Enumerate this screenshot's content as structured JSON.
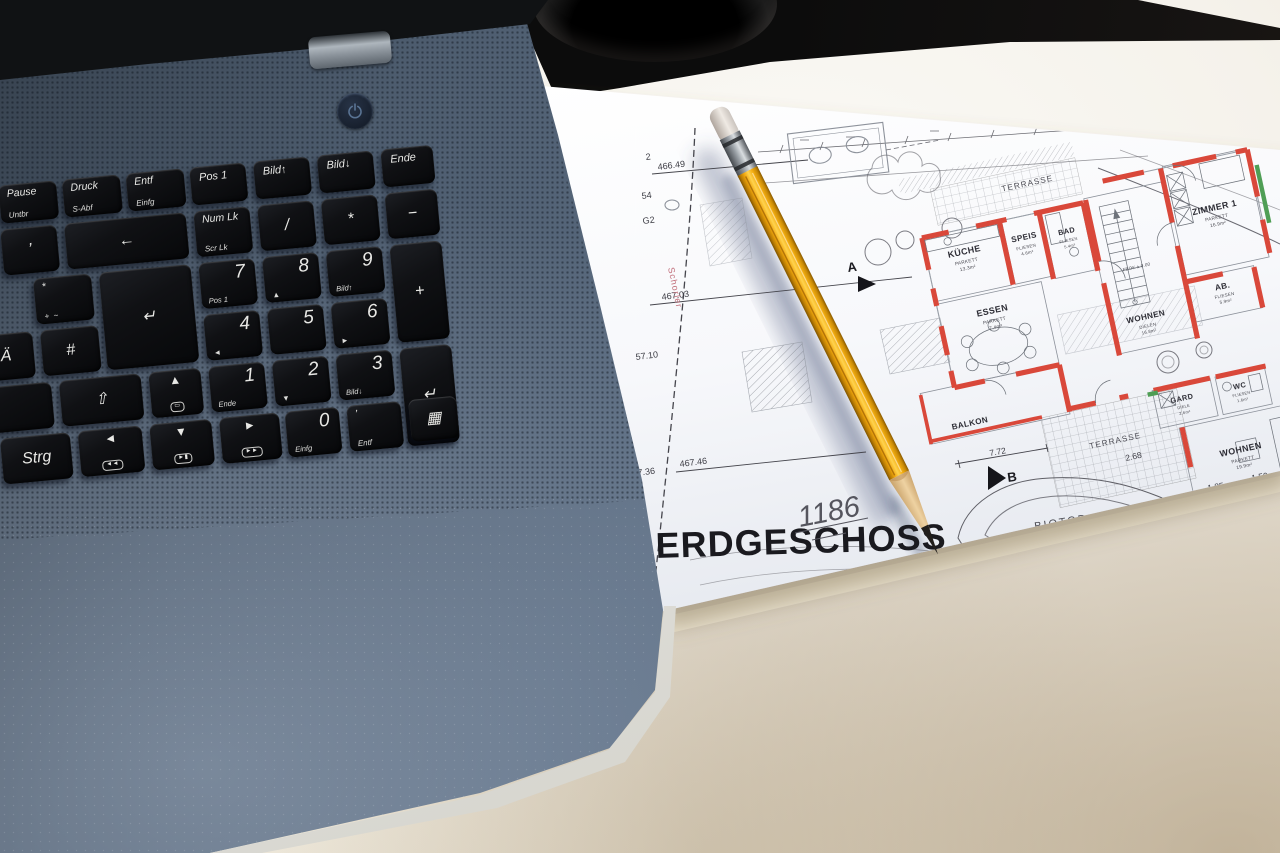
{
  "keyboard": {
    "rows": [
      [
        {
          "name": "pause",
          "label": "Pause",
          "sub": "Untbr"
        },
        {
          "name": "print",
          "label": "Druck",
          "sub": "S-Abf"
        },
        {
          "name": "delete-insert",
          "label": "Entf",
          "sub": "Einfg"
        },
        {
          "name": "home",
          "label": "Pos 1"
        },
        {
          "name": "page-up",
          "label": "Bild↑"
        },
        {
          "name": "page-down",
          "label": "Bild↓"
        },
        {
          "name": "end",
          "label": "Ende"
        }
      ],
      [
        {
          "name": "apostrophe",
          "label": "’"
        },
        {
          "name": "backspace",
          "label": "←"
        },
        {
          "name": "num-lock",
          "label": "Num Lk",
          "sub": "Scr Lk"
        },
        {
          "name": "numpad-divide",
          "label": "/"
        },
        {
          "name": "numpad-multiply",
          "label": "*"
        },
        {
          "name": "numpad-minus",
          "label": "−"
        }
      ],
      [
        {
          "name": "asterisk-plus",
          "label": "*",
          "sub": "+  ~"
        },
        {
          "name": "enter",
          "label": "↵"
        },
        {
          "name": "numpad-7",
          "label": "7",
          "sub": "Pos 1"
        },
        {
          "name": "numpad-8",
          "label": "8",
          "sub": "▲"
        },
        {
          "name": "numpad-9",
          "label": "9",
          "sub": "Bild↑"
        },
        {
          "name": "numpad-plus",
          "label": "+"
        }
      ],
      [
        {
          "name": "umlaut-a",
          "label": "Ä"
        },
        {
          "name": "hash",
          "label": "#"
        },
        {
          "name": "numpad-4",
          "label": "4",
          "sub": "◄"
        },
        {
          "name": "numpad-5",
          "label": "5"
        },
        {
          "name": "numpad-6",
          "label": "6",
          "sub": "►"
        }
      ],
      [
        {
          "name": "blank",
          "label": ""
        },
        {
          "name": "shift",
          "label": "⇧"
        },
        {
          "name": "display-toggle",
          "label": "▲",
          "pill": "▭"
        },
        {
          "name": "numpad-1",
          "label": "1",
          "sub": "Ende"
        },
        {
          "name": "numpad-2",
          "label": "2",
          "sub": "▼"
        },
        {
          "name": "numpad-3",
          "label": "3",
          "sub": "Bild↓"
        },
        {
          "name": "numpad-enter",
          "label": "↵"
        }
      ],
      [
        {
          "name": "ctrl",
          "label": "Strg"
        },
        {
          "name": "media-previous",
          "label": "◄",
          "pill": "◄◄"
        },
        {
          "name": "media-play-pause",
          "label": "▼",
          "pill": "►▮"
        },
        {
          "name": "media-next",
          "label": "►",
          "pill": "►►"
        },
        {
          "name": "numpad-0",
          "label": "0",
          "sub": "Einfg"
        },
        {
          "name": "numpad-delete",
          "label": "’",
          "sub": "Entf"
        },
        {
          "name": "calculator",
          "label": "▦"
        }
      ]
    ]
  },
  "plan": {
    "title": "ERDGESCHOSS",
    "sheet_number": "1186",
    "stamp": "Schorler",
    "elevations": {
      "e1": "2",
      "e2": "466.49",
      "e3": "54",
      "e4": "G2",
      "e5": "467.03",
      "e6": "57.10",
      "e7": "467.36",
      "e8": "467.46"
    },
    "markers": {
      "a": "A",
      "b": "B"
    },
    "rooms": [
      {
        "name": "KÜCHE",
        "material": "PARKETT",
        "area": "13.3m²"
      },
      {
        "name": "SPEIS",
        "material": "FLIESEN",
        "area": "4.6m²"
      },
      {
        "name": "BAD",
        "material": "FLIESEN",
        "area": "5.4m²"
      },
      {
        "name": "ESSEN",
        "material": "PARKETT",
        "area": "7.4m²"
      },
      {
        "name": "WOHNEN",
        "material": "DIELEN",
        "area": "16.8m²"
      },
      {
        "name": "ZIMMER 1",
        "material": "PARKETT",
        "area": "16.9m²"
      },
      {
        "name": "AB.",
        "material": "FLIESEN",
        "area": "5.9m²"
      },
      {
        "name": "GARD",
        "material": "DIELE",
        "area": "2.6m²"
      },
      {
        "name": "WC",
        "material": "FLIESEN",
        "area": "1.6m²"
      },
      {
        "name": "WOHNEN",
        "material": "PARKETT",
        "area": "19.9m²"
      },
      {
        "name": "BALKON"
      }
    ],
    "areas": {
      "terrasse_top": "TERRASSE",
      "terrasse_bottom": "TERRASSE",
      "biotop": "BIOTOP"
    },
    "level_note": "FBOK ± 0.00",
    "dimensions": {
      "d1": "7.72",
      "d2": "2.68",
      "d3": "1.85",
      "d4": "1.50",
      "d5": "4.44",
      "d6": "5.20"
    }
  }
}
